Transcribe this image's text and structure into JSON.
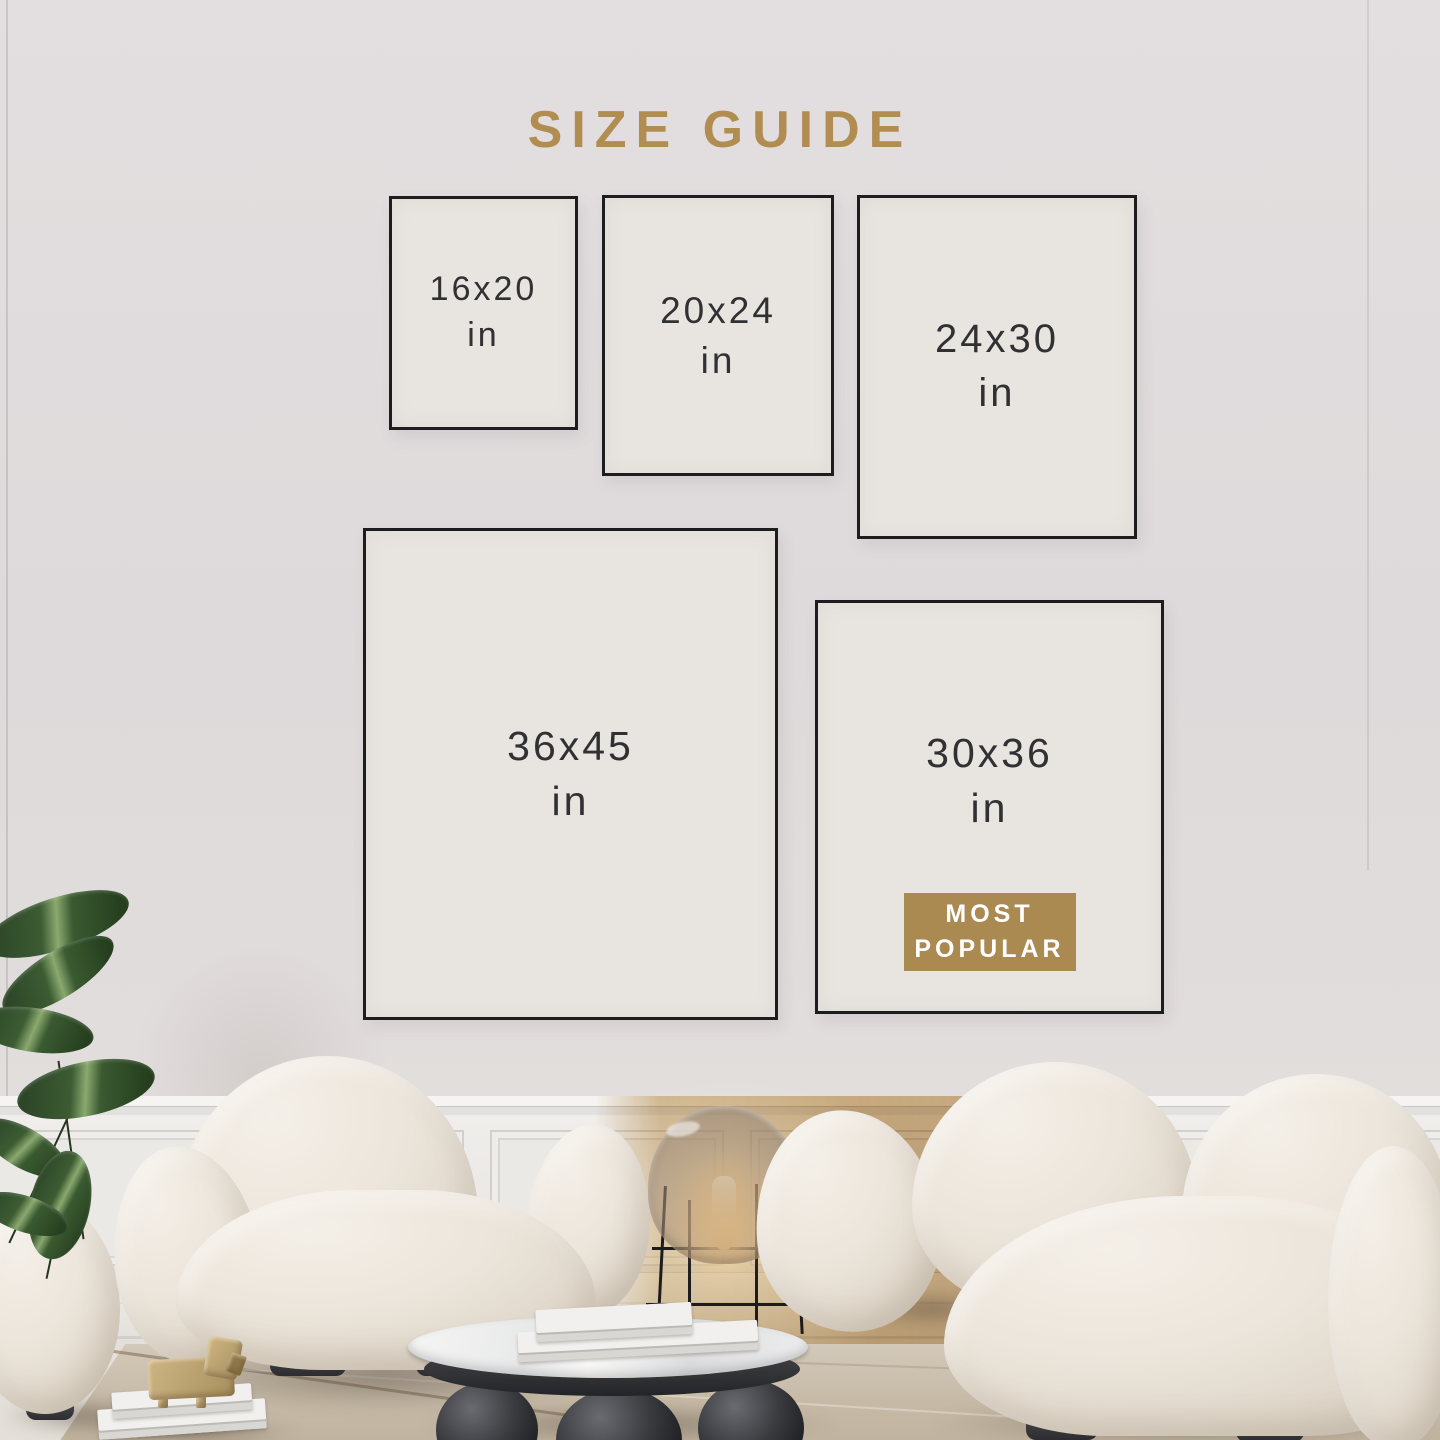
{
  "title": "SIZE GUIDE",
  "sizes": [
    {
      "label": "16x20",
      "unit": "in"
    },
    {
      "label": "20x24",
      "unit": "in"
    },
    {
      "label": "24x30",
      "unit": "in"
    },
    {
      "label": "36x45",
      "unit": "in"
    },
    {
      "label": "30x36",
      "unit": "in",
      "badge": {
        "line1": "MOST",
        "line2": "POPULAR"
      }
    }
  ],
  "colors": {
    "accent_gold": "#b28d52",
    "badge_gold": "#ab8a52",
    "box_fill": "#e8e4df",
    "box_border": "#1d1c1e",
    "box_text": "#313134",
    "wall": "#dfdbdc",
    "wainscot_tan": "#c7a36f",
    "rug": "#c7bba8"
  }
}
